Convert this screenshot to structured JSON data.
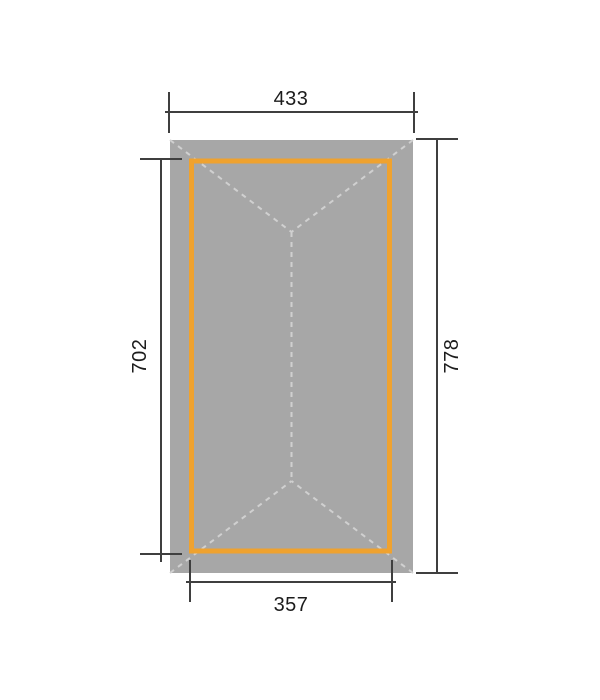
{
  "diagram": {
    "type": "technical-dimension-drawing",
    "view": "roof-plan-top-view",
    "dimensions": {
      "top": "433",
      "bottom": "357",
      "left": "702",
      "right": "778"
    },
    "colors": {
      "background": "#ffffff",
      "roof_fill": "#a7a7a7",
      "ridge_dash": "#d0d0d0",
      "frame_accent": "#efa22f",
      "dimension_line": "#3f3f3f",
      "label_text": "#1c1c1c"
    }
  }
}
